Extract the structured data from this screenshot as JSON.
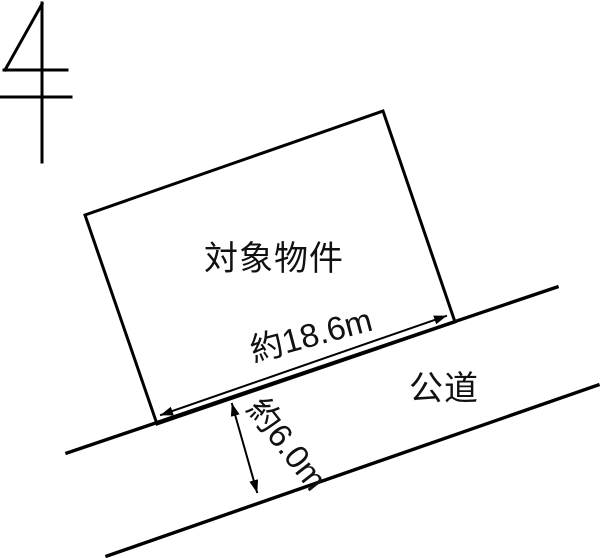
{
  "diagram": {
    "type": "land-plot-diagram",
    "north_symbol": {
      "icon": "north-arrow"
    },
    "property": {
      "label": "対象物件"
    },
    "frontage_dimension": {
      "label": "約18.6m"
    },
    "road": {
      "label": "公道"
    },
    "road_width_dimension": {
      "label": "約6.0m"
    }
  },
  "colors": {
    "ink": "#000000",
    "text": "#111111",
    "paper": "#ffffff"
  }
}
